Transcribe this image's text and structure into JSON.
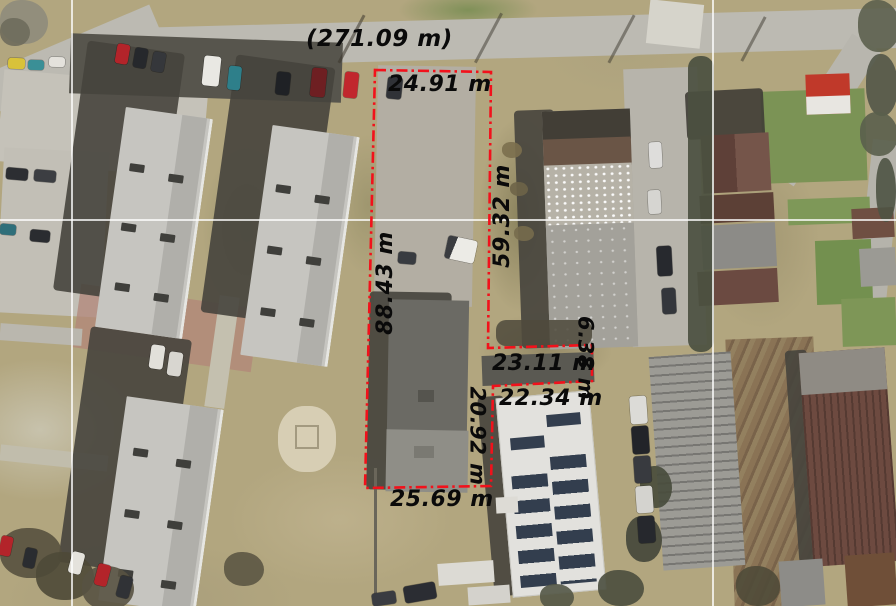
{
  "map": {
    "description": "Aerial orthophoto with red dash-dot parcel boundary and distance measurements",
    "units": "m",
    "labels": [
      {
        "id": "road-frontage-total",
        "text": "(271.09 m)",
        "orientation": "horizontal"
      },
      {
        "id": "north-edge",
        "text": "24.91 m",
        "orientation": "horizontal"
      },
      {
        "id": "east-edge-upper",
        "text": "59.32 m",
        "orientation": "vertical-up"
      },
      {
        "id": "west-edge",
        "text": "88.43 m",
        "orientation": "vertical-up"
      },
      {
        "id": "notch-north-edge",
        "text": "23.11 m",
        "orientation": "horizontal"
      },
      {
        "id": "notch-east-edge",
        "text": "6.38 m",
        "orientation": "vertical-down"
      },
      {
        "id": "notch-south-edge",
        "text": "22.34 m",
        "orientation": "horizontal"
      },
      {
        "id": "east-edge-lower",
        "text": "20.92 m",
        "orientation": "vertical-down"
      },
      {
        "id": "south-edge",
        "text": "25.69 m",
        "orientation": "horizontal"
      }
    ],
    "boundary": {
      "color": "#f2111b",
      "style": "dash-dot",
      "points": "375,70 491,72 488,348 592,345 592,381 493,386 491,486 365,488"
    },
    "grid_lines": {
      "color": "#ffffff",
      "horizontal_y": [
        219
      ],
      "vertical_x": [
        72,
        712
      ]
    }
  }
}
